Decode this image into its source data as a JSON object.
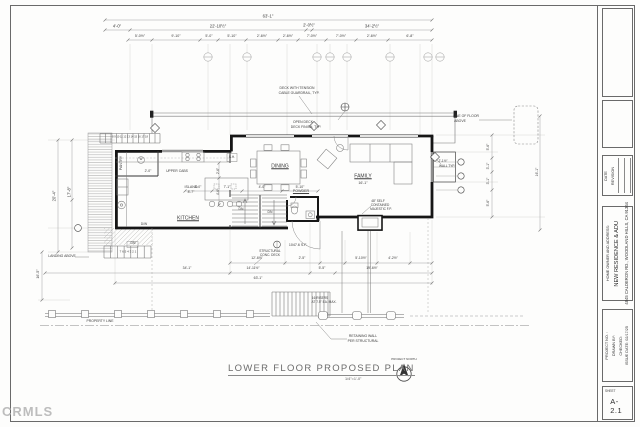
{
  "watermark": "CRMLS",
  "drawing": {
    "title": "LOWER FLOOR PROPOSED PLAN",
    "scale": "1/4\"=1'-0\"",
    "north_label": "PROJECT NORTH"
  },
  "title_block": {
    "revision_header_date": "DATE",
    "revision_header_revision": "REVISION",
    "owner_label": "HOME OWNER AND ADDRESS:",
    "owner_name": "NEW RESIDENCE & ADU",
    "owner_address": "4845 CALDERON RD., WOODLAND HILLS, CA 91364",
    "project_no_label": "PROJECT NO. :",
    "drawn_by_label": "DRAWN BY:",
    "checked_label": "CHECKED:",
    "issue_date_label": "ISSUE DATE: 02/17/25",
    "sheet_label": "SHEET",
    "sheet_number": "A-2.1"
  },
  "plan": {
    "labels": [
      {
        "t": "63'-1\"",
        "x": 268,
        "y": 17
      },
      {
        "t": "4'-0\"",
        "x": 117,
        "y": 27
      },
      {
        "t": "22'-10½\"",
        "x": 218,
        "y": 27
      },
      {
        "t": "2'-0½\"",
        "x": 309,
        "y": 26
      },
      {
        "t": "34'-2½\"",
        "x": 372,
        "y": 27
      },
      {
        "t": "5'-0½\"",
        "x": 140,
        "y": 37,
        "s": 3.6
      },
      {
        "t": "9'-10\"",
        "x": 176,
        "y": 37,
        "s": 3.6
      },
      {
        "t": "5'-0\"",
        "x": 209,
        "y": 37,
        "s": 3.6
      },
      {
        "t": "5'-10\"",
        "x": 232,
        "y": 37,
        "s": 3.6
      },
      {
        "t": "2'-6½\"",
        "x": 262,
        "y": 37,
        "s": 3.6
      },
      {
        "t": "2'-6½\"",
        "x": 288,
        "y": 37,
        "s": 3.6
      },
      {
        "t": "7'-0½\"",
        "x": 312,
        "y": 37,
        "s": 3.6
      },
      {
        "t": "7'-0½\"",
        "x": 341,
        "y": 37,
        "s": 3.6
      },
      {
        "t": "2'-6½\"",
        "x": 372,
        "y": 37,
        "s": 3.6
      },
      {
        "t": "6'-8\"",
        "x": 410,
        "y": 37,
        "s": 3.6
      },
      {
        "t": "20'-4\"",
        "x": 55,
        "y": 196,
        "r": -90
      },
      {
        "t": "17'-8\"",
        "x": 70,
        "y": 192,
        "r": -90
      },
      {
        "t": "LANDING ABOVE",
        "x": 62,
        "y": 257,
        "s": 3.4,
        "n": "landing-above-note"
      },
      {
        "t": "16'-5\"",
        "x": 39,
        "y": 274,
        "r": -90,
        "s": 3.6
      },
      {
        "t": "PANTRY",
        "x": 122,
        "y": 163,
        "r": -90,
        "s": 3.6,
        "n": "room-label-pantry"
      },
      {
        "t": "W",
        "x": 141,
        "y": 160,
        "s": 3.2
      },
      {
        "t": "2'-0\"",
        "x": 148,
        "y": 172,
        "s": 3.4
      },
      {
        "t": "UPPER CABS",
        "x": 177,
        "y": 172,
        "s": 3.4
      },
      {
        "t": "ISLAND",
        "x": 191,
        "y": 188,
        "s": 3.6
      },
      {
        "t": "8'-7\"",
        "x": 191,
        "y": 193,
        "s": 3.4
      },
      {
        "t": "KITCHEN",
        "x": 188,
        "y": 219,
        "u": 1,
        "s": 5,
        "n": "room-label-kitchen"
      },
      {
        "t": "D/W",
        "x": 144,
        "y": 225,
        "s": 3.2
      },
      {
        "t": "S.H.",
        "x": 232,
        "y": 158,
        "s": 3.2
      },
      {
        "t": "2'-6\"",
        "x": 219,
        "y": 171,
        "r": -90,
        "s": 3.2
      },
      {
        "t": "4'-6\"",
        "x": 219,
        "y": 192,
        "r": -90,
        "s": 3.2
      },
      {
        "t": "8 9 10 11 12 13 14 15 16 17 18",
        "x": 130,
        "y": 138,
        "s": 2.6
      },
      {
        "t": "DINING",
        "x": 280,
        "y": 167,
        "u": 1,
        "s": 5,
        "n": "room-label-dining"
      },
      {
        "t": "FAMILY",
        "x": 363,
        "y": 177,
        "u": 1,
        "s": 5,
        "n": "room-label-family"
      },
      {
        "t": "16'-1\"",
        "x": 363,
        "y": 184,
        "s": 3.6
      },
      {
        "t": "POWDER",
        "x": 301,
        "y": 192,
        "u": 1,
        "s": 3.6,
        "n": "room-label-powder"
      },
      {
        "t": "48\" SELF",
        "x": 378,
        "y": 202,
        "s": 3.2
      },
      {
        "t": "CONTAINED",
        "x": 380,
        "y": 206,
        "s": 3.2
      },
      {
        "t": "MAJESTIC F.P.",
        "x": 381,
        "y": 210,
        "s": 3.2
      },
      {
        "t": "DECK WITH TENSION",
        "x": 297,
        "y": 89,
        "s": 3.4,
        "n": "deck-guardrail-note"
      },
      {
        "t": "CABLE GUARDRAIL, TYP.",
        "x": 299,
        "y": 94,
        "s": 3.4
      },
      {
        "t": "OPEN DECK",
        "x": 303,
        "y": 123,
        "s": 3.4,
        "n": "open-deck-note"
      },
      {
        "t": "DECK FINISH, TYP.",
        "x": 306,
        "y": 128,
        "s": 3.4
      },
      {
        "t": "LINE OF FLOOR",
        "x": 466,
        "y": 117,
        "s": 3.4,
        "n": "line-of-floor-note"
      },
      {
        "t": "ABOVE",
        "x": 460,
        "y": 122,
        "s": 3.4
      },
      {
        "t": "2'-1½\"",
        "x": 443,
        "y": 162,
        "s": 3.2
      },
      {
        "t": "WALL TYP.",
        "x": 447,
        "y": 167,
        "s": 3.2
      },
      {
        "t": "5'-6\"",
        "x": 489,
        "y": 147,
        "r": -90,
        "s": 3.4
      },
      {
        "t": "3'-1\"",
        "x": 489,
        "y": 166,
        "r": -90,
        "s": 3.4
      },
      {
        "t": "3'-1\"",
        "x": 489,
        "y": 181,
        "r": -90,
        "s": 3.4
      },
      {
        "t": "5'-6\"",
        "x": 489,
        "y": 203,
        "r": -90,
        "s": 3.4
      },
      {
        "t": "16'-1\"",
        "x": 538,
        "y": 172,
        "r": -90,
        "s": 3.4
      },
      {
        "t": "3'-0\"",
        "x": 198,
        "y": 188,
        "s": 3.4
      },
      {
        "t": "7'-1\"",
        "x": 227,
        "y": 188,
        "s": 3.4
      },
      {
        "t": "4'-0\"",
        "x": 262,
        "y": 188,
        "s": 3.4
      },
      {
        "t": "5'-10\"",
        "x": 300,
        "y": 188,
        "s": 3.4
      },
      {
        "t": "DN",
        "x": 241,
        "y": 210,
        "s": 3.4
      },
      {
        "t": "DN",
        "x": 270,
        "y": 213,
        "s": 3.4
      },
      {
        "t": "DN",
        "x": 133,
        "y": 244,
        "s": 3.4
      },
      {
        "t": "7 6 5 4 3 2 1",
        "x": 128,
        "y": 252,
        "s": 3
      },
      {
        "t": "1047.6 S.F.",
        "x": 298,
        "y": 246,
        "s": 3.6,
        "n": "area-label"
      },
      {
        "t": "STRUCTURAL",
        "x": 270,
        "y": 252,
        "s": 3.2,
        "n": "structural-deck-note"
      },
      {
        "t": "CONC. DECK",
        "x": 270,
        "y": 256,
        "s": 3.2
      },
      {
        "t": "12'-6½\"",
        "x": 257,
        "y": 259,
        "s": 3.4
      },
      {
        "t": "2'-5\"",
        "x": 302,
        "y": 259,
        "s": 3.4
      },
      {
        "t": "5'-10½\"",
        "x": 361,
        "y": 259,
        "s": 3.4
      },
      {
        "t": "4'-2½\"",
        "x": 393,
        "y": 259,
        "s": 3.4
      },
      {
        "t": "34'-1\"",
        "x": 187,
        "y": 269,
        "s": 3.4
      },
      {
        "t": "14'-11½\"",
        "x": 253,
        "y": 269,
        "s": 3.4
      },
      {
        "t": "5'-5\"",
        "x": 322,
        "y": 269,
        "s": 3.4
      },
      {
        "t": "19'-6½\"",
        "x": 372,
        "y": 269,
        "s": 3.4
      },
      {
        "t": "63'-1\"",
        "x": 258,
        "y": 279,
        "s": 3.4
      },
      {
        "t": "16 RISERS",
        "x": 320,
        "y": 299,
        "s": 3.2,
        "n": "risers-note"
      },
      {
        "t": "AT 7.5\" EA. MAX.",
        "x": 324,
        "y": 303,
        "s": 3.2
      },
      {
        "t": "RETAINING WALL",
        "x": 363,
        "y": 337,
        "s": 3.4,
        "n": "retaining-wall-note"
      },
      {
        "t": "PER STRUCTURAL",
        "x": 363,
        "y": 342,
        "s": 3.4
      },
      {
        "t": "PROPERTY LINE",
        "x": 100,
        "y": 322,
        "s": 3.4,
        "n": "property-line-label"
      }
    ]
  }
}
